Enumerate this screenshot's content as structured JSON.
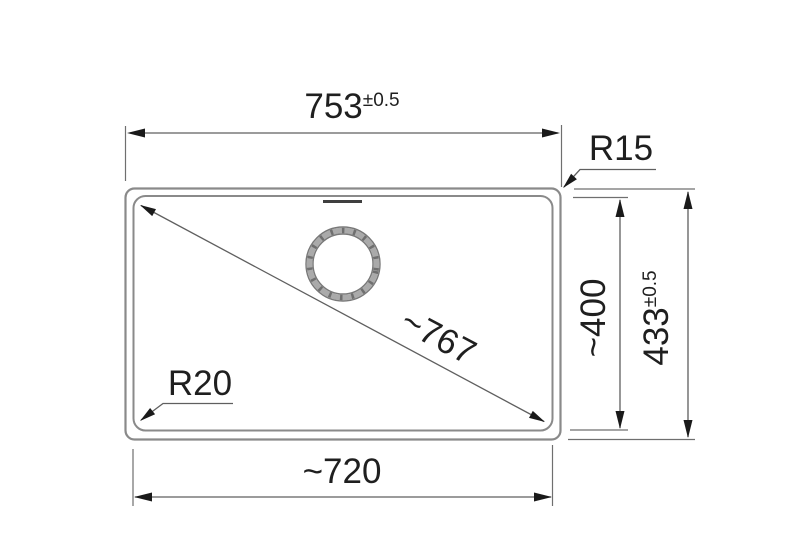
{
  "drawing": {
    "title": "Sink dimension drawing",
    "colors": {
      "background": "#ffffff",
      "outline": "#8a8a8a",
      "dimension_line": "#5f5f5f",
      "arrow_and_text": "#1a1a1a",
      "drain_ring": "#aaaaaa",
      "overflow_mark": "#3f3f3f"
    },
    "dimensions": {
      "outer_width": {
        "value": "753",
        "tolerance": "±0.5"
      },
      "outer_height": {
        "value": "433",
        "tolerance": "±0.5"
      },
      "inner_width": {
        "value": "~720"
      },
      "inner_height": {
        "value": "~400"
      },
      "diagonal": {
        "value": "~767"
      },
      "outer_corner_radius": {
        "label": "R15"
      },
      "inner_corner_radius": {
        "label": "R20"
      }
    }
  }
}
